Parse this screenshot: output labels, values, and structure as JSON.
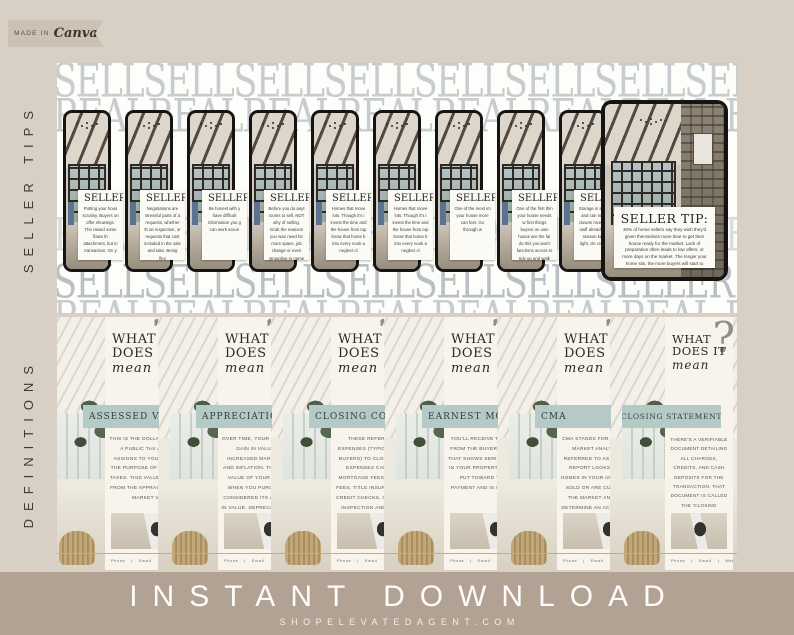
{
  "badge": {
    "made_in": "MADE IN",
    "brand": "Canva"
  },
  "side_labels": {
    "top": "SELLER TIPS",
    "bottom": "DEFINITIONS"
  },
  "tips_panel": {
    "bg_rows": {
      "row1": "SELLSELLSELLSELLSELLSELLSELLSELLER TIP",
      "row2": "REALREALREALREALREALREALREAL ESTATE",
      "row3": "REALREALREALREALREALREALREAL ESTATE",
      "row4": "SELLSELLSELLSELLSELLSELLSELLER TIPS",
      "row5": "REALREALREALREALREALREALREAL ESTATE"
    },
    "card_heading": "SELLER TIP:",
    "phones": [
      {
        "tip": "Putting your hous scrutiny. Buyers on offer showings. The raised some flaws th attachment, but in transaction. On y"
      },
      {
        "tip": "Negotiations are stressful parts of a requests, whether th an inspection, or requests that cost included in the sale and take. Being flex"
      },
      {
        "tip": "Be honest with y have difficult information you g can work aroun"
      },
      {
        "tip": "Before you do anyt rooms to sell, NOT why of selling. Grab the reasons you wan need for more space, job change or even struggling to name y mort"
      },
      {
        "tip": "Homes that move lots. Though it's i invest the time and the house from top know that home b into every nook a neglect cl"
      },
      {
        "tip": "Homes that move lots. Though it's i invest the time and the house from top know that home b into every nook a neglect cl"
      },
      {
        "tip": "One of the most im your house more can feel. Go through w"
      },
      {
        "tip": "One of the first thin your house needs w first things buyers on own house are the far do this you won't functions across to tidy up and walk aw"
      },
      {
        "tip": "Storage is somethi and can never s closets nice an the stuff alread clutter season keep it light, cle crowded"
      }
    ],
    "featured": {
      "heading": "SELLER TIP:",
      "tip": "30% of home sellers say they wish they'd given themselves more time to get their house ready for the market. Lack of preparation often leads to low offers, or more days on the market. The longer your home sits, the more buyers will start to wonder if something's wrong with it or why it hasn't sold. Take time to list your house and it will pay off in the end."
    }
  },
  "definitions_panel": {
    "heading_line1": "WHAT",
    "heading_line2": "DOES IT",
    "heading_script": "mean",
    "question_mark": "?",
    "cards": [
      {
        "term": "ASSESSED VALUE",
        "definition": "THIS IS THE DOLLAR VALUE THAT A PUBLIC TAX ASSESSOR ASSIGNS TO YOUR HOME FOR THE PURPOSE OF CALCULATING TAXES. THIS VALUE IS SEPARATE FROM THE APPRAISAL VALUE OR MARKET VALUE."
      },
      {
        "term": "APPRECIATION",
        "definition": "OVER TIME, YOUR HOME SHOULD GAIN IN VALUE DUE TO INCREASED MARKET DEMAND AND INFLATION. THE INCREASED VALUE OF YOUR HOME FROM WHEN YOU PURCHASED IT IS CONSIDERED ITS APPRECIATION IN VALUE. DEPRECIATION REFERS TO A DECREASE IN VALUE."
      },
      {
        "term": "CLOSING COSTS",
        "definition": "THESE REFER TO MISC. EXPENSES (TYPICALLY PAID BY BUYERS) TO CLOSE THE SALE. EXPENSES CAN INCLUDE MORTGAGE FEES, RECORDING FEES, TITLE INSURANCE, TAXES, CREDIT CHECKS, COMMISSIONS, INSPECTION AND APPRAISAL FEES, AND MORE."
      },
      {
        "term": "EARNEST MONEY",
        "definition": "YOU'LL RECEIVE THIS PAYMENT FROM THE BUYER AS AN OFFER THAT SHOWS SERIOUS INTEREST IN YOUR PROPERTY. IT IS OFTEN PUT TOWARD THE DOWN PAYMENT AND IS REFUNDABLE."
      },
      {
        "term": "CMA",
        "definition": "CMA STANDS FOR COMPARATIVE MARKET ANALYSIS, ALSO REFERRED TO AS 'COMPS'. THE REPORT LOOKS AT SIMILAR HOMES IN YOUR AREA THAT HAVE SOLD OR ARE CURRENTLY ON THE MARKET AND CAN HELP DETERMINE AN ACCURATE PRICE FOR YOUR HOME."
      },
      {
        "term": "CLOSING STATEMENT",
        "definition": "THERE'S A VERIFIABLE DOCUMENT DETAILING ALL CHARGES, CREDITS, AND CASH DEPOSITS FOR THE TRANSACTION. THAT DOCUMENT IS CALLED THE 'CLOSING STATEMENT.'"
      }
    ],
    "footer": {
      "phone": "Phone",
      "divider": "|",
      "email": "Email",
      "website": "Website"
    }
  },
  "footer_bar": {
    "title": "INSTANT DOWNLOAD",
    "website": "SHOPELEVATEDAGENT.COM"
  },
  "colors": {
    "page_bg": "#d8d0c5",
    "panel_bg": "#fdfdfa",
    "bg_text": "#c7ccce",
    "card_cream": "#f8f4eb",
    "banner_sage": "#b5cac6",
    "bar_taupe": "#b2a294",
    "phone_frame": "#151412"
  }
}
